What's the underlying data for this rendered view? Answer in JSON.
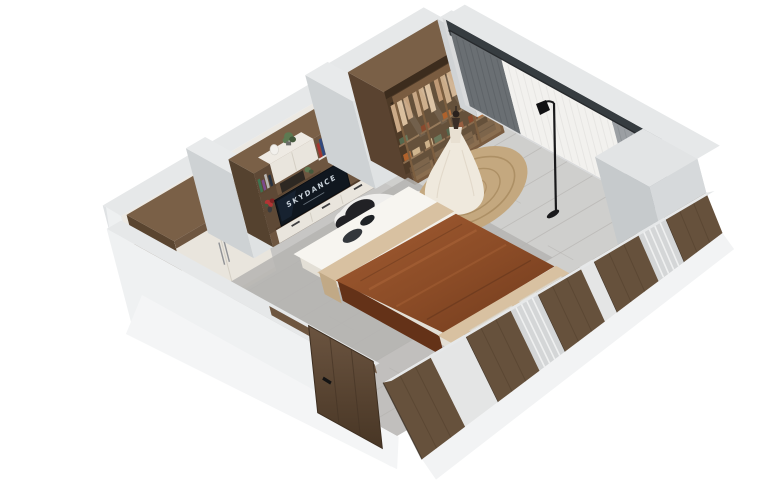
{
  "meta": {
    "description": "3D isometric cutaway render of a bedroom interior",
    "canvas_width": 780,
    "canvas_height": 490,
    "background": "#ffffff"
  },
  "scene": {
    "tv": {
      "text": "SKYDANCE",
      "screen_color": "#10171f"
    },
    "palette": {
      "bg": "#ffffff",
      "wallTop": "#e6e8e9",
      "wallFace": "#dfe2e4",
      "wallShade": "#c3c7ca",
      "wallInterior": "#ece9e3",
      "windowDark": "#363c40",
      "floor": "#c7c6c4",
      "floorLight": "#d8d7d5",
      "floorShade": "#aeaca9",
      "floorLine": "#b3b1ae",
      "walnut": "#6e5640",
      "walnutTop": "#7a6047",
      "walnutSide": "#55422f",
      "walnutDark": "#503c2b",
      "walnutLight": "#8a6c4e",
      "shelfWood": "#5c4733",
      "cabinetWhite": "#e9e5dd",
      "cabinetSeam": "#d2cdc2",
      "tvScreen": "#10171f",
      "tvText": "#c9d2da",
      "closetInner": "#4e3a27",
      "glassTint": "rgba(226,203,168,0.16)",
      "frameWood": "#7a5c40",
      "mullion": "#7d5f40",
      "blanketA": "#a25c32",
      "blanketB": "#6f3a1d",
      "blanketSide": "#643218",
      "throwBeige": "#d8c1a1",
      "throwSide": "#c1a986",
      "sheet": "#f2efe9",
      "sheetSide": "#e3dfd6",
      "pillow": "#ebe5d9",
      "cowWhite": "#efeeec",
      "cowBlack": "#212125",
      "rugGray": "#b5b4b2",
      "jute": "#c4a87f",
      "juteRing": "#a8895f",
      "dress": "#efe9dd",
      "dressShade": "#ded5c5",
      "mannequin": "#3a2e26",
      "curtainDark": "#6a6f73",
      "curtainDarkLine": "#595e62",
      "curtainMid": "#9b9fa3",
      "curtainMidLine": "#878c90",
      "sheer": "#f2f1ee",
      "sheerLine": "#e3e2df",
      "rod": "#26292c",
      "lamp": "#19191b",
      "doorWood": "#5f4936",
      "doorWoodDark": "#463526",
      "handle": "#141414",
      "flowerRed": "#b13434",
      "flowerDark": "#7e2323",
      "plantGreen": "#5d7a52",
      "plantDark": "#44593c",
      "panelWood": "#66513c",
      "panelWoodLine": "#53402d",
      "panelLight": "#d4d6d7",
      "panelSlat": "#f2f3f3",
      "panelWhite": "#e4e5e5",
      "eggWhite": "#f2f0ec",
      "blockTop": "#e2e4e5",
      "blockFront": "#d6d9db",
      "blockSide": "#c6cacc"
    },
    "books": {
      "colors": [
        "#a33530",
        "#31497f",
        "#c9822f",
        "#3f7350",
        "#7c4a8c",
        "#b8b6b2",
        "#27313f",
        "#c7a43b",
        "#8c2f2f",
        "#2f6f6f",
        "#d0cdc8",
        "#b45a2c"
      ]
    },
    "closet": {
      "door_count": 4,
      "clothes_colors": [
        "#cbaa87",
        "#d9bd9d",
        "#c09a76",
        "#c7a684"
      ],
      "folded_colors": [
        "#b0622c",
        "#cdb18a",
        "#55684e",
        "#8a4a2e"
      ]
    },
    "objects": [
      {
        "name": "left-wardrobe"
      },
      {
        "name": "media-wall-tv-unit"
      },
      {
        "name": "bookshelf"
      },
      {
        "name": "glass-door-wardrobe"
      },
      {
        "name": "window-curtains"
      },
      {
        "name": "floor-lamp"
      },
      {
        "name": "wedding-dress-mannequin"
      },
      {
        "name": "round-platform-rug"
      },
      {
        "name": "bed"
      },
      {
        "name": "cowhide-rug"
      },
      {
        "name": "entry-door"
      },
      {
        "name": "slat-panel-front-wall"
      }
    ]
  }
}
